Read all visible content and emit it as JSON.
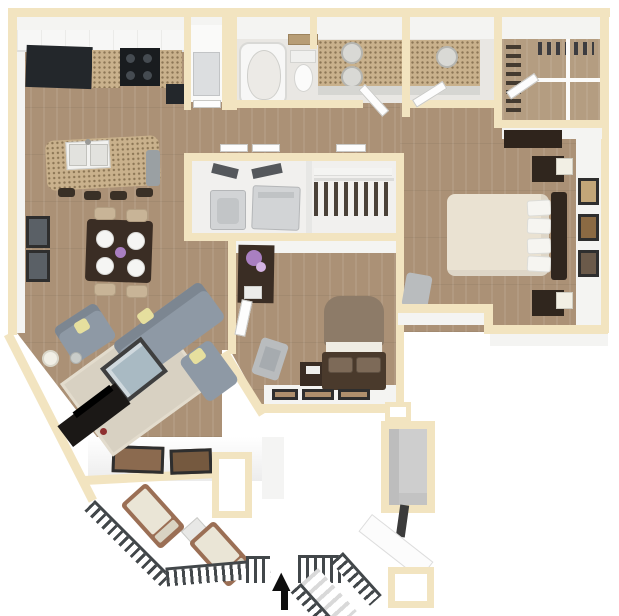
{
  "meta": {
    "title": "3D apartment floor plan rendering",
    "canvas_width": 619,
    "canvas_height": 616
  },
  "entry": {
    "arrow_glyph": "▲"
  },
  "colors": {
    "wall": "#f2e4c0",
    "walledge": "#e6d2a4",
    "wood": "#ab9176",
    "wood2": "#b49d81",
    "bathfloor": "#e9e7e3",
    "granite": "#c9b18c",
    "dark": "#23272b",
    "stove": "#191c1f",
    "appliance": "#d2d4d6",
    "sofa": "#8e99a5",
    "pillow": "#e6df9e",
    "rug": "#d8d1c2",
    "tabledark": "#3a2d24",
    "glass": "#a9bac3",
    "tv": "#1b1816",
    "bedmaster": "#eae2d2",
    "bedguest": "#8d7b68",
    "framedark": "#2e2e2e",
    "rail": "#42474a",
    "woodchair": "#9b6f55",
    "cushion": "#eae5d6",
    "lamp": "#f2efe4",
    "chairtan": "#c8b497",
    "purple": "#a97fc1",
    "red": "#8e2f2f"
  },
  "floor_plan": {
    "rooms": [
      {
        "name": "kitchen",
        "furniture": [
          "upper-cabinets",
          "black-corner-cabinet",
          "stove-4-burners",
          "granite-backsplash",
          "granite-island-double-sink",
          "dishwasher-end-cap",
          "bar-stools-x4"
        ]
      },
      {
        "name": "dining-area",
        "furniture": [
          "dark-table",
          "plates-x4",
          "purple-centerpiece",
          "tan-chairs-x4",
          "wall-art-x2"
        ]
      },
      {
        "name": "living-room",
        "furniture": [
          "gray-sectional-sofa",
          "gray-armchair",
          "yellow-pillows",
          "area-rug",
          "glass-coffee-table",
          "tv-console",
          "tv",
          "floor-lamp",
          "side-table"
        ]
      },
      {
        "name": "pantry",
        "furniture": [
          "refrigerator"
        ]
      },
      {
        "name": "bathroom-1",
        "furniture": [
          "bathtub",
          "toilet",
          "shelf",
          "double-sink-granite-vanity",
          "door"
        ]
      },
      {
        "name": "bathroom-2",
        "furniture": [
          "single-sink-granite-vanity",
          "door"
        ]
      },
      {
        "name": "walk-in-closet",
        "furniture": [
          "wire-shelving",
          "hanging-clothes"
        ]
      },
      {
        "name": "laundry-closet",
        "furniture": [
          "washer",
          "dryer",
          "bifold-doors"
        ]
      },
      {
        "name": "hall-closet",
        "furniture": [
          "shelf",
          "hanging-rod",
          "hanging-clothes"
        ]
      },
      {
        "name": "bedroom-2",
        "furniture": [
          "desk-with-flowers",
          "gray-chair",
          "nightstand",
          "bed-taupe",
          "patterned-pillows-x2",
          "leaning-frames-x3"
        ]
      },
      {
        "name": "master-bedroom",
        "furniture": [
          "dresser",
          "bed-cream",
          "white-pillows",
          "headboard",
          "nightstands-x2",
          "lamps-x2",
          "wall-art-x3",
          "gray-chair",
          "door"
        ]
      },
      {
        "name": "balcony",
        "furniture": [
          "wall-art-x2",
          "lounge-chairs-x2",
          "side-table",
          "railing",
          "stairs"
        ]
      },
      {
        "name": "entry-porch",
        "furniture": [
          "railing-segments",
          "stairs",
          "entry-arrow",
          "vestibule"
        ]
      },
      {
        "name": "patio-storage",
        "furniture": [
          "storage-closet",
          "column-pad"
        ]
      }
    ]
  }
}
